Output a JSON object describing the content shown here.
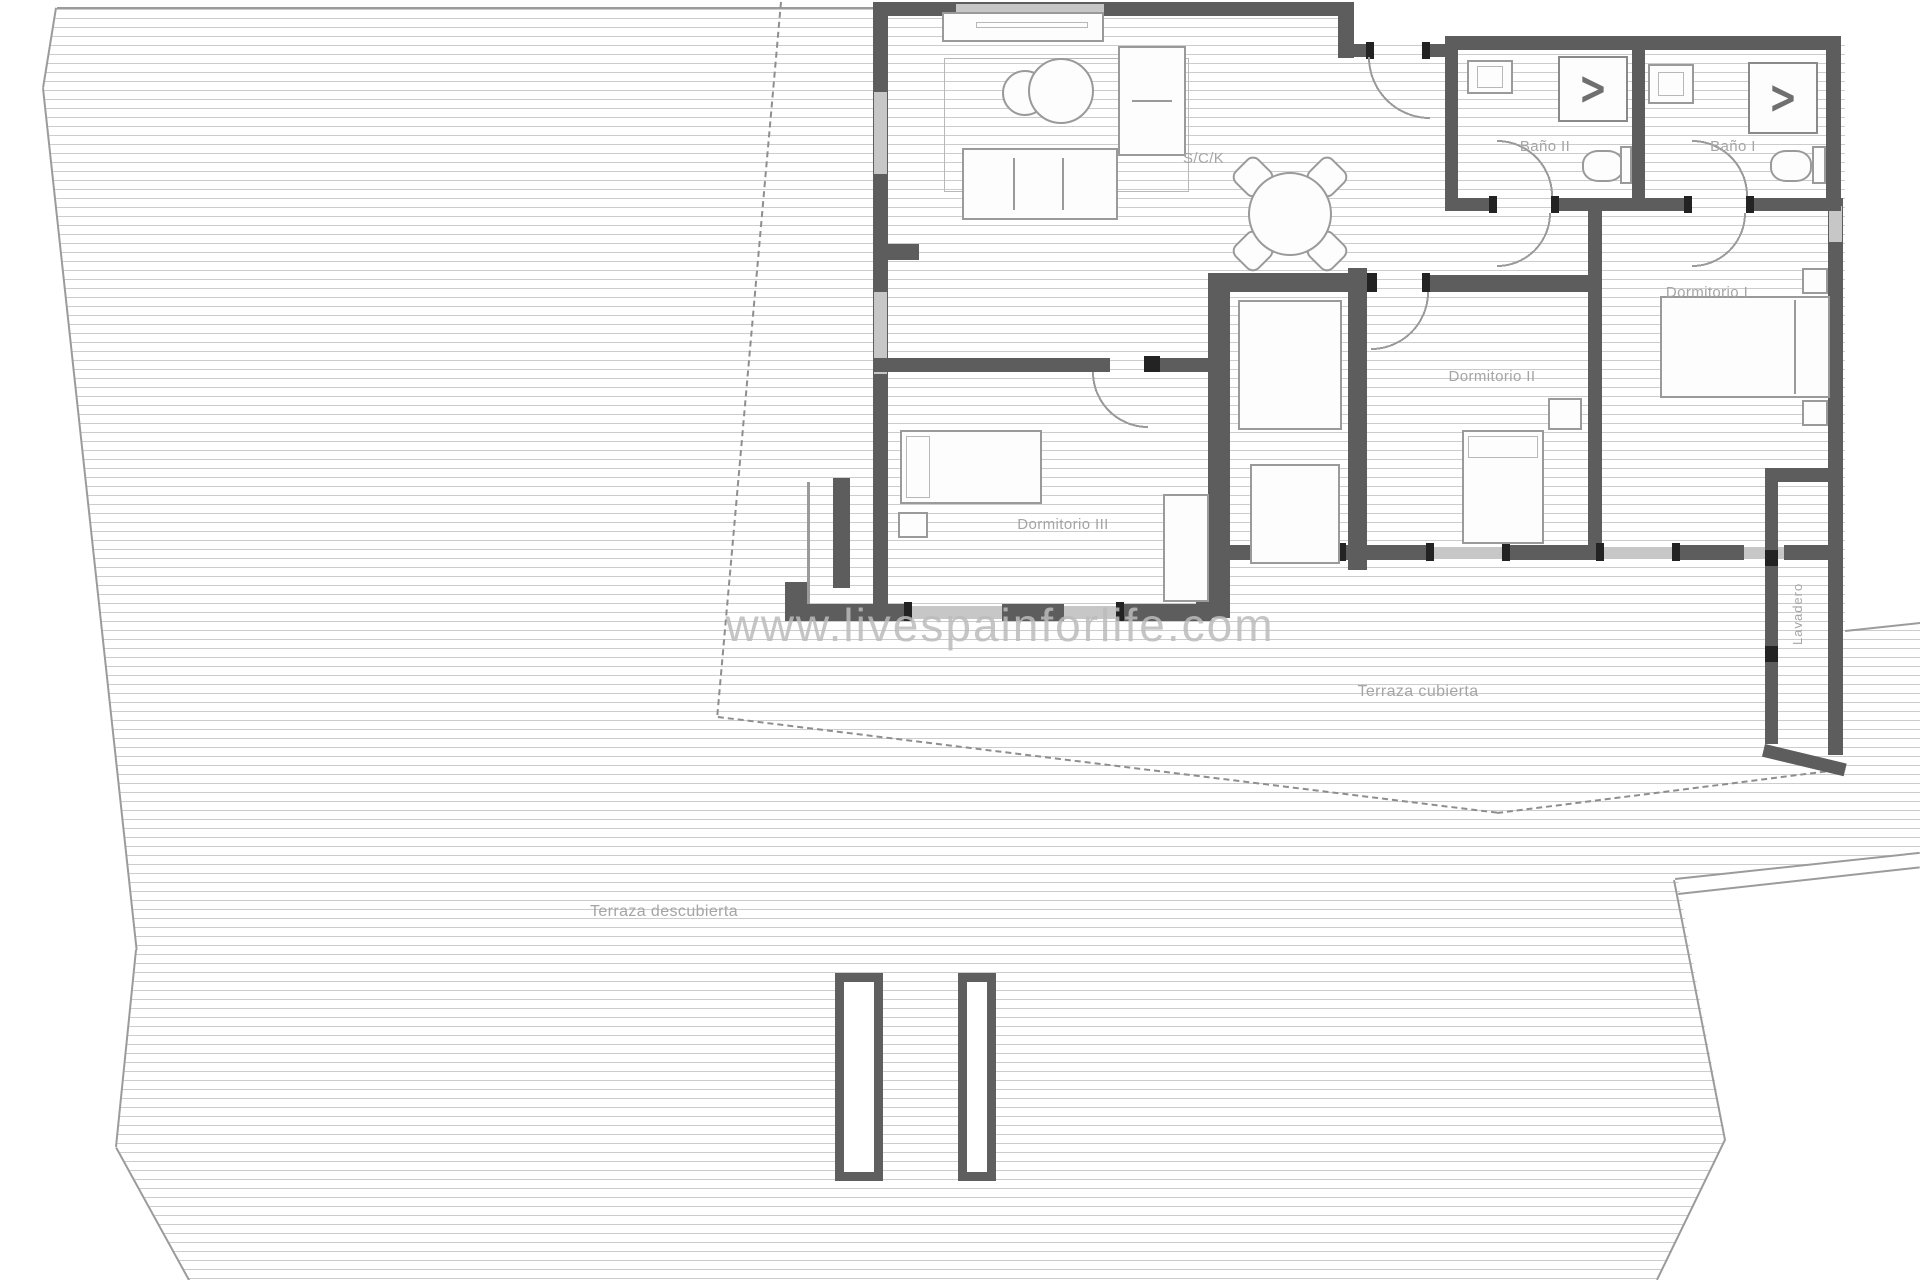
{
  "watermark": "www.livespainforlife.com",
  "rooms": {
    "sck": "S/C/K",
    "bano2": "Baño II",
    "bano1": "Baño I",
    "dorm1": "Dormitorio I",
    "dorm2": "Dormitorio II",
    "dorm3": "Dormitorio III",
    "lavadero": "Lavadero",
    "terraza_cubierta": "Terraza cubierta",
    "terraza_descubierta": "Terraza descubierta"
  },
  "symbols": {
    "shower": ">"
  },
  "colors": {
    "wall": "#5d5d5d",
    "door_jamb": "#232323",
    "furniture_outline": "#9a9a9a",
    "deck_line": "#cccccc",
    "label_text": "#a5a5a5",
    "watermark_text": "#bcbcbc"
  }
}
